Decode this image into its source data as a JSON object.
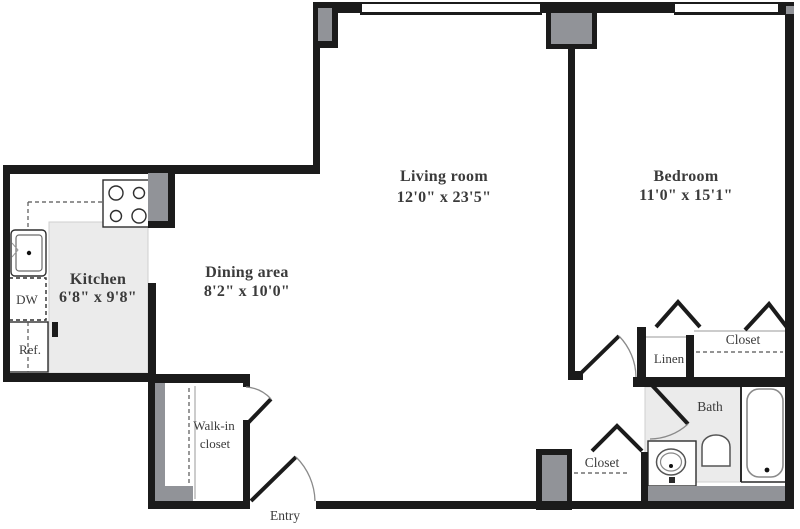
{
  "title": "One-bedroom apartment floor plan",
  "colors": {
    "wall": "#1b1b1b",
    "column": "#919398",
    "floor": "#ebebeb",
    "text": "#3b3b3b",
    "line": "#8a8a8a"
  },
  "rooms": [
    {
      "name": "Living room",
      "dims": "12'0\" x 23'5\""
    },
    {
      "name": "Bedroom",
      "dims": "11'0\" x 15'1\""
    },
    {
      "name": "Dining area",
      "dims": "8'2\" x 10'0\""
    },
    {
      "name": "Kitchen",
      "dims": "6'8\" x 9'8\""
    }
  ],
  "labels": {
    "walk_in_line1": "Walk-in",
    "walk_in_line2": "closet",
    "entry": "Entry",
    "linen": "Linen",
    "bedroom_closet": "Closet",
    "hall_closet": "Closet",
    "bath": "Bath",
    "dishwasher": "DW",
    "refrigerator": "Ref."
  }
}
